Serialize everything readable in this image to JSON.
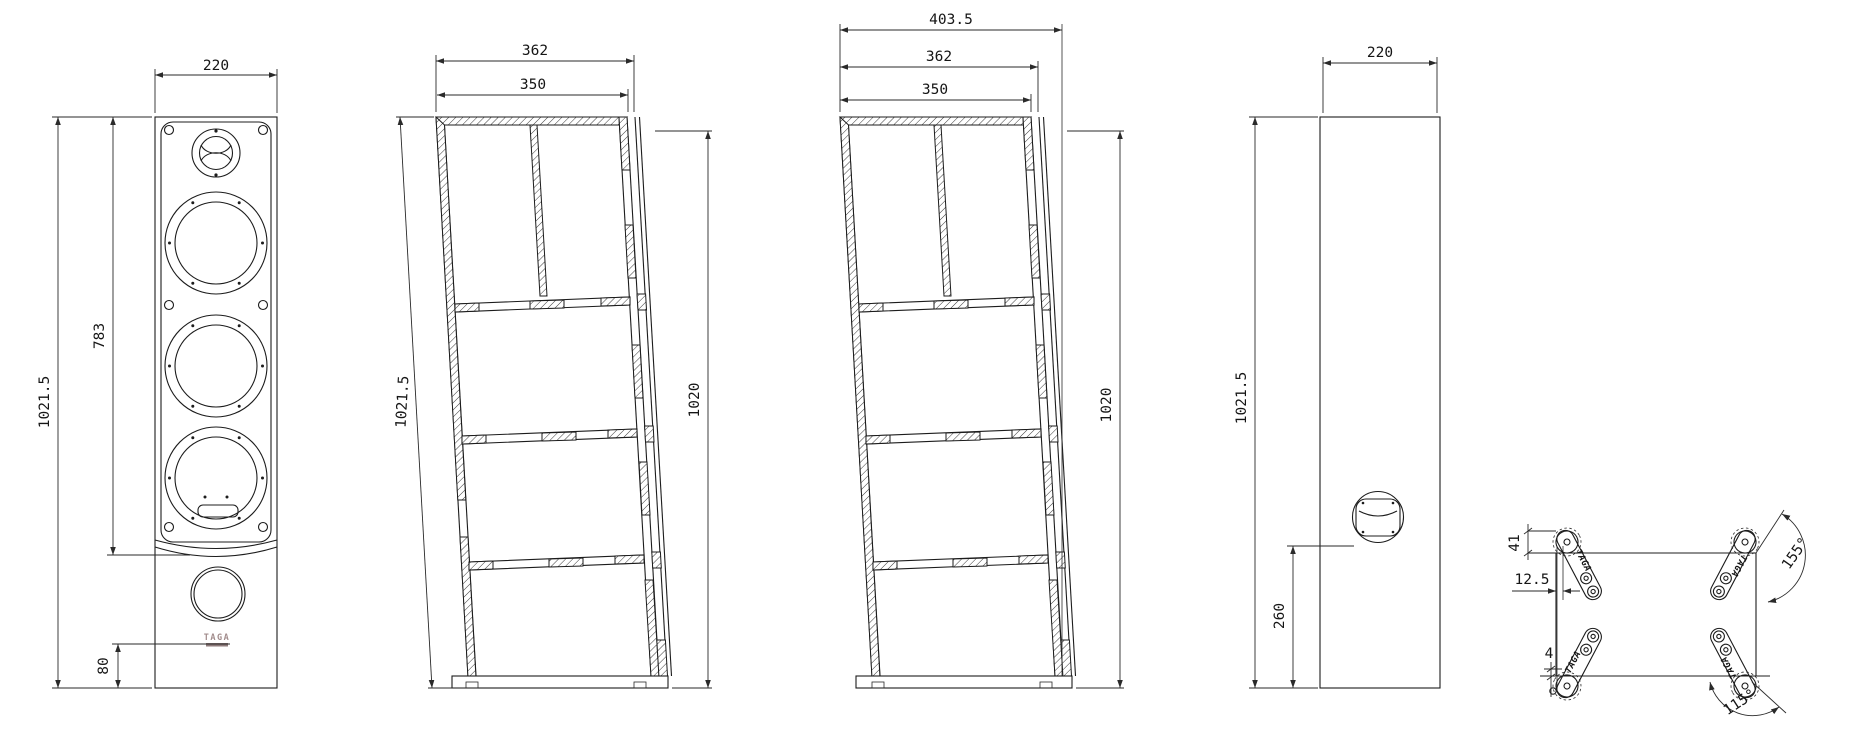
{
  "brand": {
    "logo_text": "TAGA"
  },
  "front_view": {
    "width": "220",
    "total_height": "1021.5",
    "baffle_height": "783",
    "logo_offset": "80"
  },
  "section_a": {
    "depth_with_grille": "362",
    "cabinet_depth": "350",
    "slant_height": "1021.5",
    "back_height": "1020"
  },
  "section_b": {
    "total_depth": "403.5",
    "depth_with_grille": "362",
    "cabinet_depth": "350",
    "back_height": "1020"
  },
  "side_view": {
    "width": "220",
    "height": "1021.5",
    "port_height": "260"
  },
  "base_view": {
    "foot_top_offset": "41",
    "foot_side_offset": "12.5",
    "foot_bottom_offset": "4",
    "front_foot_angle": "155°",
    "rear_foot_angle": "115°",
    "foot_label": "TAGA"
  }
}
